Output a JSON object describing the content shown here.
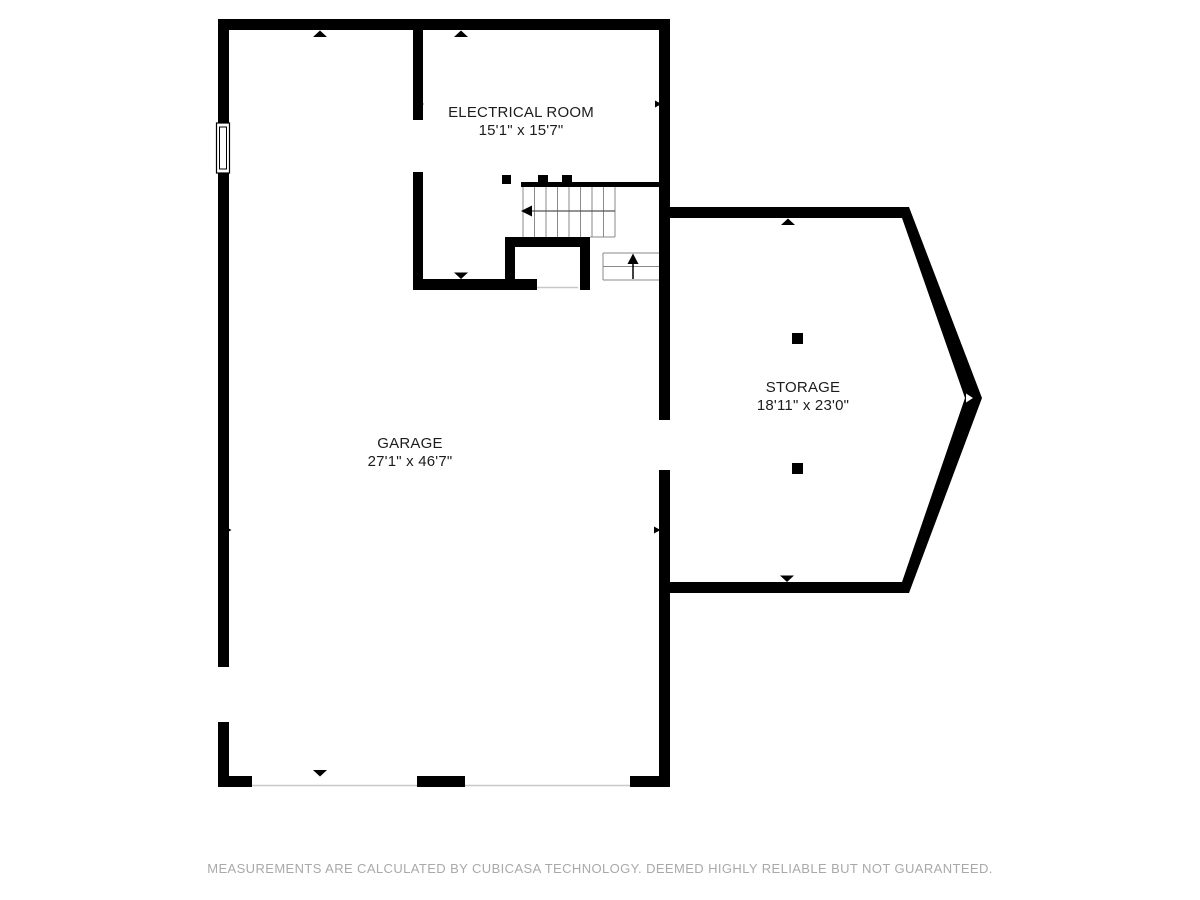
{
  "floor_plan": {
    "rooms": [
      {
        "id": "electrical-room",
        "name": "ELECTRICAL ROOM",
        "dimensions": "15'1\" x 15'7\""
      },
      {
        "id": "garage",
        "name": "GARAGE",
        "dimensions": "27'1\" x 46'7\""
      },
      {
        "id": "storage",
        "name": "STORAGE",
        "dimensions": "18'11\" x 23'0\""
      }
    ],
    "symbols": {
      "window": "window-icon",
      "stair_down_arrow": "stair-arrow-left",
      "stair_up_arrow": "stair-arrow-up"
    },
    "colors": {
      "wall": "#000000",
      "background": "#ffffff",
      "stair_line": "#8a8a8a",
      "threshold_line": "#c8c8c8",
      "label_text": "#1c1c1c",
      "footer_text": "#a7a9ab"
    }
  },
  "footer": {
    "disclaimer": "MEASUREMENTS ARE CALCULATED BY CUBICASA TECHNOLOGY. DEEMED HIGHLY RELIABLE BUT NOT GUARANTEED."
  }
}
